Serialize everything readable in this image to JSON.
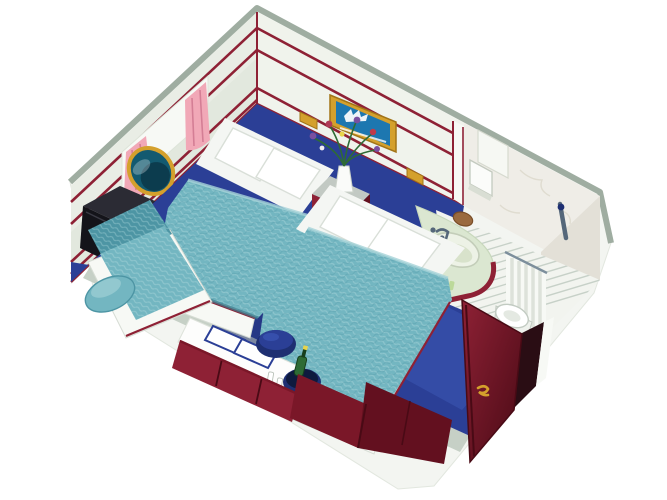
{
  "scene": {
    "type": "3d-cutaway-illustration",
    "subject": "Cruise ship inside stateroom cutaway with twin beds and bathroom",
    "background": "#ffffff",
    "palette": {
      "wall": "#e9ede5",
      "wallLight": "#f0f3ec",
      "wallShade": "#dde4d9",
      "wallEdge": "#9fada1",
      "cutTop": "#c6d0c6",
      "hull": "#f3f5f1",
      "hullShade": "#e2e7df",
      "maroon": "#8e2135",
      "maroonMid": "#7a1728",
      "maroonDark": "#63101f",
      "maroonDeep": "#490a15",
      "teal": "#73b6c1",
      "tealLight": "#a6d3d8",
      "tealDark": "#4d95a4",
      "tealShadow": "#3f7f8f",
      "navy": "#2b3f96",
      "navyLight": "#3c57b5",
      "navyDark": "#1e2f72",
      "gold": "#d4a02c",
      "goldDark": "#a27417",
      "pictureBlue": "#1d77b0",
      "glass": "#135a70",
      "glassDark": "#0c3c4e",
      "pink": "#f1a8b7",
      "pinkDark": "#d47e95",
      "offWhite": "#f7f9f5",
      "paper": "#fdfdfc",
      "tile": "#f2f4ef",
      "tileLine": "#c7d1c8",
      "bathWall": "#efede7",
      "bathWallShade": "#e3e0d7",
      "counter": "#dbe7d1",
      "counterShade": "#c8d8bc",
      "basin": "#edf2e6",
      "chrome": "#7d8f9c",
      "chromeDark": "#55677a",
      "black": "#14141a",
      "blackLight": "#2b2b34",
      "green": "#2e6b35",
      "greenDark": "#173f1d",
      "brown": "#9a6a3f",
      "brownDark": "#7a4e28"
    },
    "labels": {
      "room": "cabin room shell",
      "leftWall": "left wall with porthole window",
      "backWall": "back wall with picture",
      "porthole": "porthole window",
      "curtains": "pink window curtains",
      "tv": "corner television",
      "switch": "light switch",
      "picture": "framed sailing ship picture",
      "sconces": "gold wall lamps",
      "nightstand": "nightstand with flower vase",
      "flowers": "flower bouquet",
      "bed1": "twin bed near window",
      "bed2": "twin bed near bathroom",
      "sofa": "teal corner sofa",
      "carpet": "navy blue carpet",
      "desk": "vanity desk with papers",
      "papers": "papers on desk",
      "bucket": "champagne bucket with bottle",
      "stool": "navy vanity stool",
      "dresser": "maroon dresser cabinets",
      "wardrobe": "maroon wardrobe",
      "door": "open cabin door",
      "bathroom": "bathroom with sink, toilet and shower",
      "sink": "curved sink counter",
      "toilet": "toilet",
      "shower": "shower curtain",
      "dispenser": "towel dispenser",
      "bathFloor": "tiled bathroom floor"
    }
  }
}
